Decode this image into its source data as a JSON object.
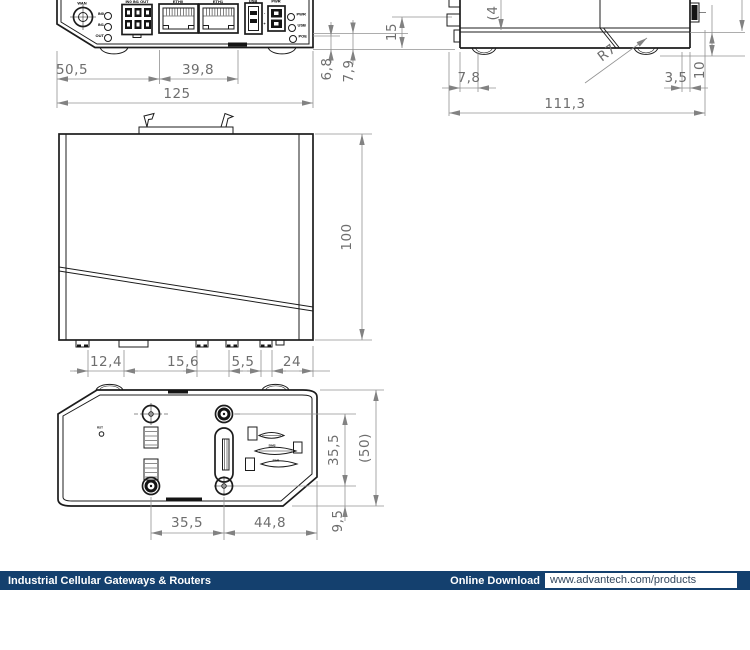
{
  "drawing": {
    "front_view": {
      "labels": {
        "antenna": "WAN",
        "led_in0": "IN0",
        "led_in1": "IN1",
        "led_out": "OUT",
        "io_header": "IN0 IN1 OUT",
        "eth0": "ETH0",
        "eth1": "ETH1",
        "usb": "USB",
        "pwr": "PWR",
        "minus": "-",
        "plus": "+",
        "led_pwr": "PWR",
        "led_usb": "USB",
        "led_poe": "POE"
      },
      "dims": {
        "d50_5": "50,5",
        "d39_8": "39,8",
        "d125": "125",
        "d6_8": "6,8",
        "d7_9": "7,9",
        "d15": "15"
      }
    },
    "side_view": {
      "dims": {
        "d7_8": "7,8",
        "d3_5": "3,5",
        "d111_3": "111,3",
        "r7": "R7",
        "d10": "10",
        "d4": "(4"
      }
    },
    "top_view": {
      "dims": {
        "d100": "100",
        "d12_4": "12,4",
        "d15_6": "15,6",
        "d5_5": "5,5",
        "d24": "24"
      }
    },
    "bottom_view": {
      "labels": {
        "reset": "RST",
        "sim2": "SIM2",
        "sim1": "SIM1"
      },
      "dims": {
        "d35_5_side": "35,5",
        "d50": "(50)",
        "d9_5": "9,5",
        "d35_5": "35,5",
        "d44_8": "44,8"
      }
    }
  },
  "footer": {
    "left_label": "Industrial Cellular Gateways & Routers",
    "download_label": "Online Download",
    "url": "www.advantech.com/products",
    "bar_color": "#14406e"
  }
}
